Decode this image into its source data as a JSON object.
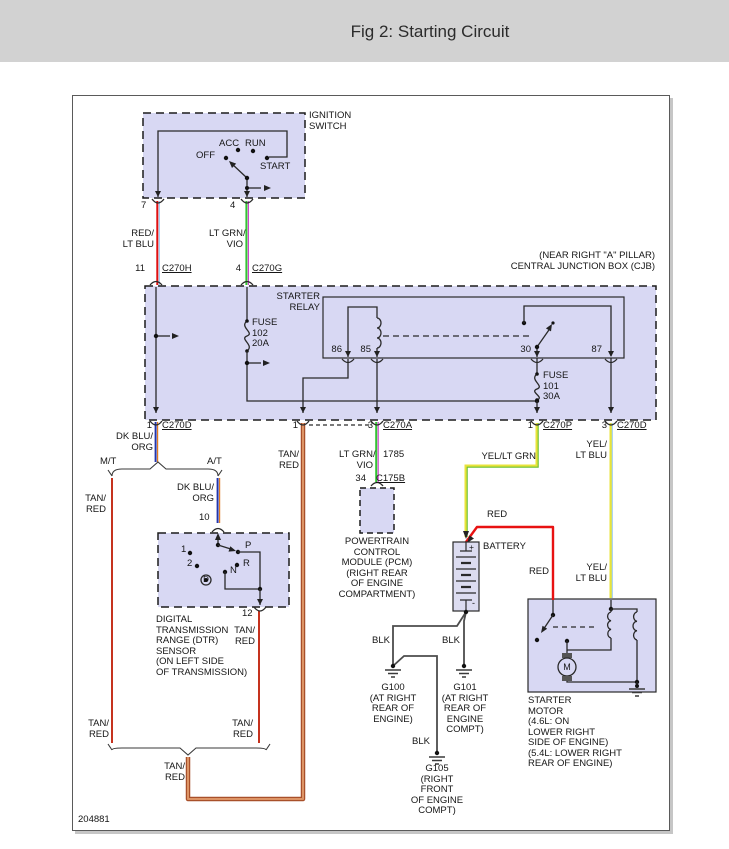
{
  "header": {
    "title": "Fig 2: Starting Circuit"
  },
  "figure_number": "204881",
  "ignition": {
    "title": "IGNITION\nSWITCH",
    "off": "OFF",
    "acc": "ACC",
    "run": "RUN",
    "start": "START",
    "pin7": "7",
    "pin4": "4"
  },
  "cjb": {
    "location": "(NEAR RIGHT \"A\" PILLAR)\nCENTRAL JUNCTION BOX (CJB)",
    "relay": "STARTER\nRELAY",
    "fuse102": "FUSE\n102\n20A",
    "fuse101": "FUSE\n101\n30A",
    "pin86": "86",
    "pin85": "85",
    "pin30": "30",
    "pin87": "87"
  },
  "connectors": {
    "c270h_pin": "11",
    "c270h": "C270H",
    "c270g_pin": "4",
    "c270g": "C270G",
    "c270d_left_pin": "1",
    "c270d_left": "C270D",
    "c270a_pin1": "1",
    "c270a_pin3": "3",
    "c270a": "C270A",
    "c270p_pin": "1",
    "c270p": "C270P",
    "c270d_right_pin": "3",
    "c270d_right": "C270D",
    "c175b_pin": "34",
    "c175b": "C175B"
  },
  "wires": {
    "red_ltblu": "RED/\nLT BLU",
    "ltgrn_vio": "LT GRN/\nVIO",
    "dkblu_org_top": "DK BLU/\nORG",
    "dkblu_org_at": "DK BLU/\nORG",
    "mt": "M/T",
    "at": "A/T",
    "tan_red_mt_upper": "TAN/\nRED",
    "tan_red_c270a": "TAN/\nRED",
    "ltgrn_vio_pcm": "LT GRN/\nVIO",
    "circuit_1785": "1785",
    "tan_red_dtr12": "TAN/\nRED",
    "tan_red_mt_lower": "TAN/\nRED",
    "tan_red_at_lower": "TAN/\nRED",
    "tan_red_main": "TAN/\nRED",
    "yel_ltgrn": "YEL/LT GRN",
    "yel_ltblu_top": "YEL/\nLT BLU",
    "yel_ltblu_bot": "YEL/\nLT BLU",
    "red_top": "RED",
    "red_bot": "RED",
    "blk_g100": "BLK",
    "blk_g101": "BLK",
    "blk_g105": "BLK"
  },
  "dtr": {
    "pin10": "10",
    "pin12": "12",
    "pos1": "1",
    "pos2": "2",
    "posd": "D",
    "posn": "N",
    "posr": "R",
    "posp": "P",
    "label": "DIGITAL\nTRANSMISSION\nRANGE (DTR)\nSENSOR\n(ON LEFT SIDE\nOF TRANSMISSION)"
  },
  "pcm": {
    "label": "POWERTRAIN\nCONTROL\nMODULE (PCM)\n(RIGHT REAR\nOF ENGINE\nCOMPARTMENT)"
  },
  "battery": {
    "label": "BATTERY",
    "plus": "+",
    "minus": "-"
  },
  "starter": {
    "label": "STARTER\nMOTOR\n(4.6L: ON\nLOWER RIGHT\nSIDE OF ENGINE)\n(5.4L: LOWER RIGHT\nREAR OF ENGINE)",
    "motor_m": "M"
  },
  "grounds": {
    "g100": "G100\n(AT RIGHT\nREAR OF\nENGINE)",
    "g101": "G101\n(AT RIGHT\nREAR OF\nENGINE\nCOMPT)",
    "g105": "G105\n(RIGHT\nFRONT\nOF ENGINE\nCOMPT)"
  },
  "colors": {
    "box_fill": "#d8d8f3",
    "line": "#2a2a2a",
    "red": "#e01010",
    "lt_blu": "#9ccdf2",
    "lt_grn": "#33c433",
    "vio": "#cc44cc",
    "dk_blu": "#2335ab",
    "org": "#e07a20",
    "tan_red": "#c5321e",
    "tan": "#d99068",
    "yellow": "#e8e33a",
    "grn_stripe": "#6abf30",
    "black_wire": "#4c4c4c"
  }
}
